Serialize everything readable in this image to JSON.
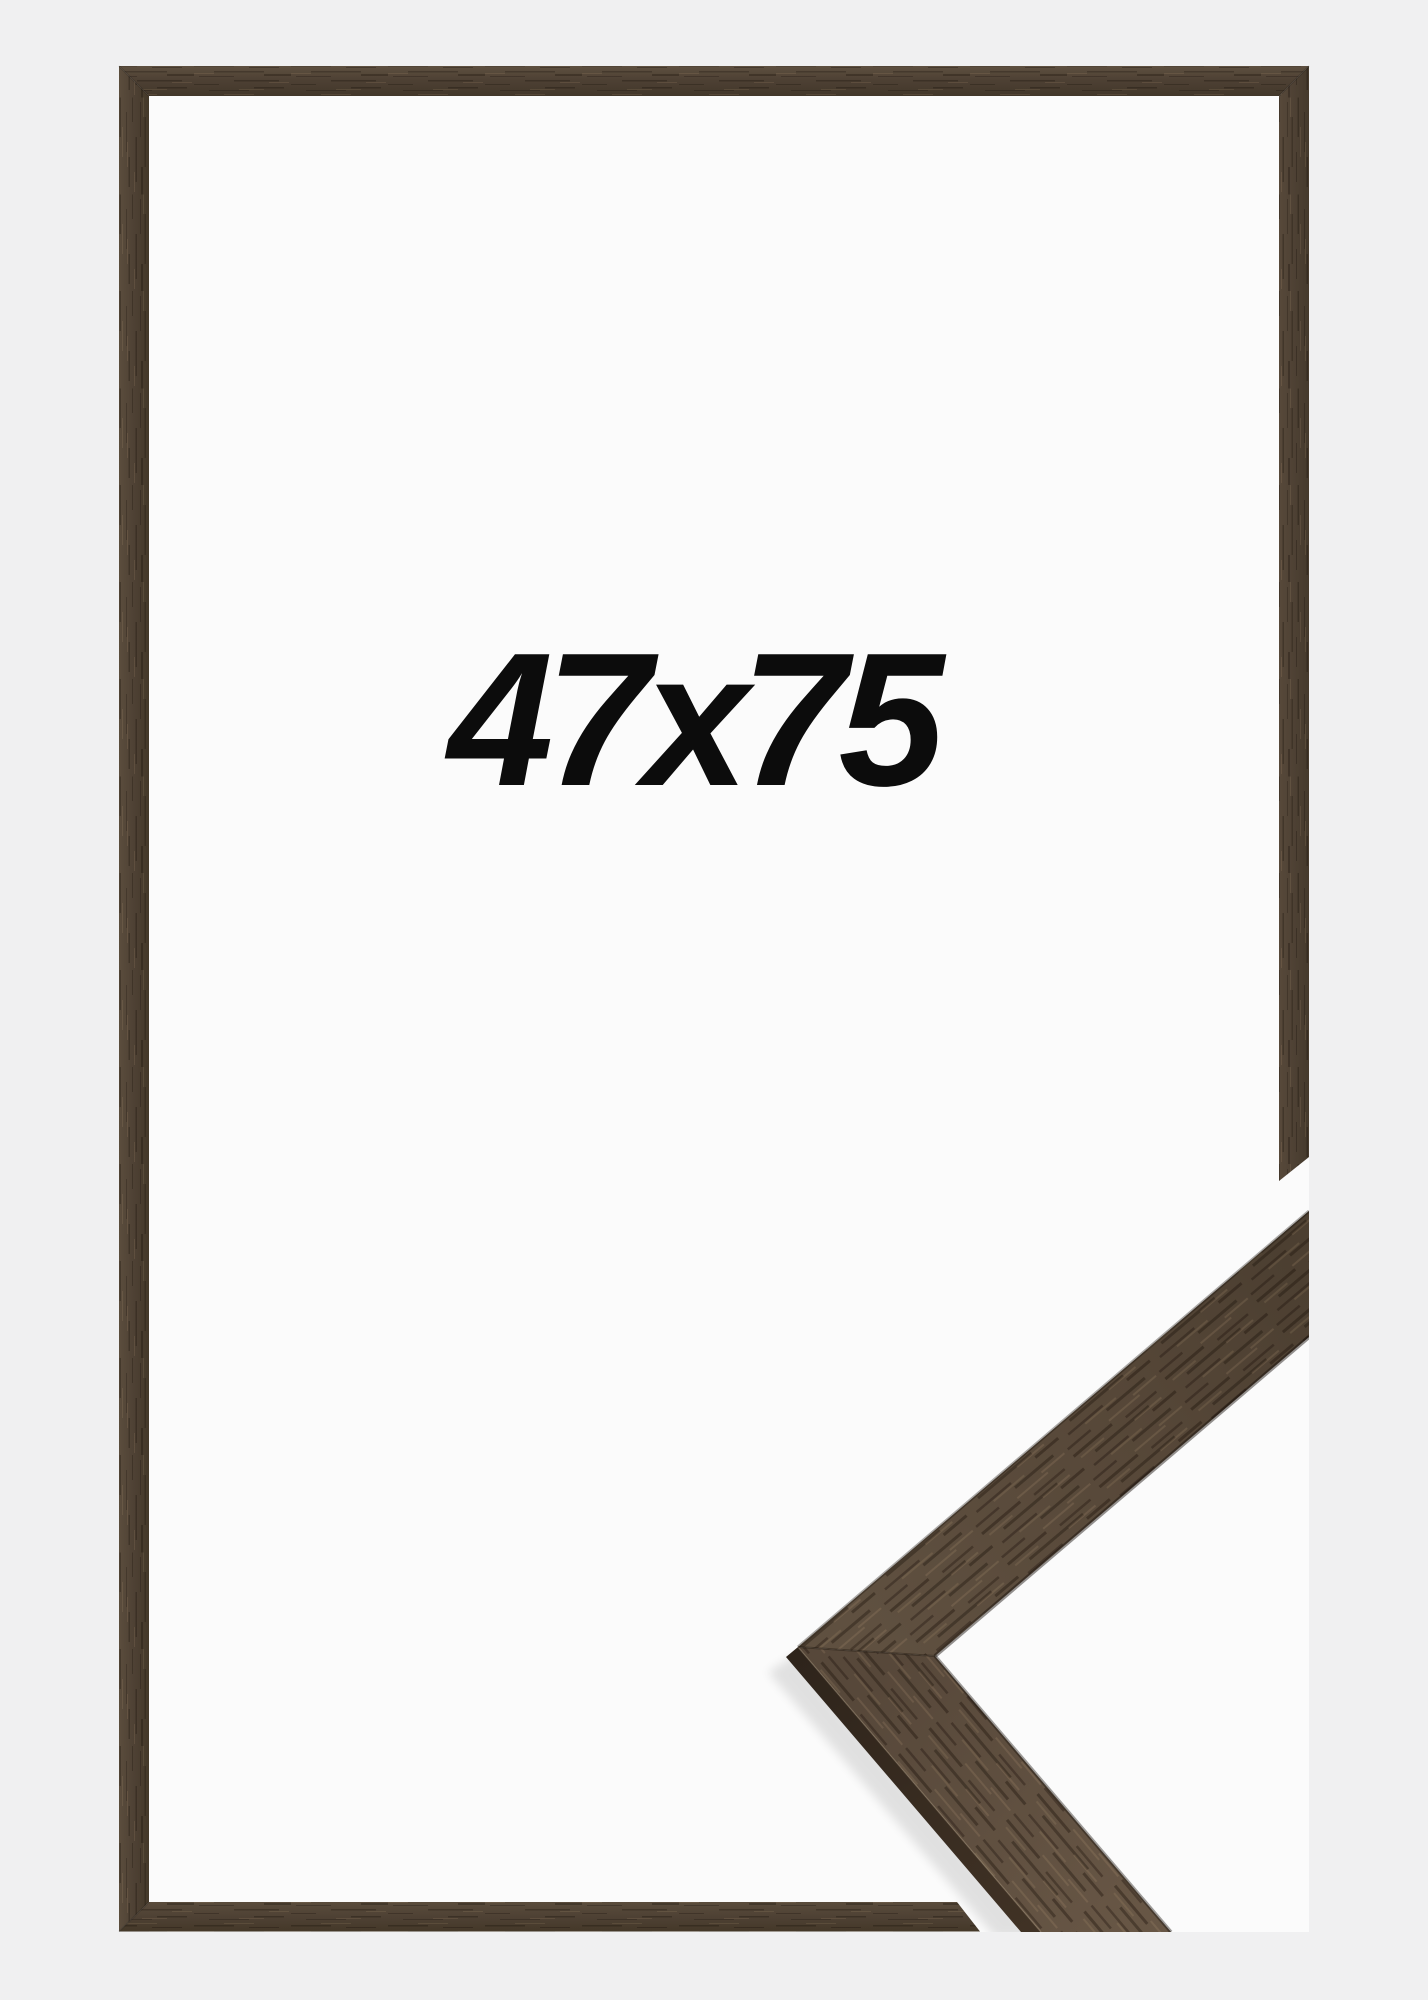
{
  "product": {
    "size_label": "47x75"
  },
  "colors": {
    "canvas_bg": "#f0f0f1",
    "inner_bg": "#fbfbfb",
    "label_text": "#0c0c0c",
    "frame_wood_base": "#4e4134",
    "moulding_wood_base": "#594a3b",
    "moulding_wood_lower": "#5e4e3e",
    "moulding_side_face": "#362b20"
  }
}
